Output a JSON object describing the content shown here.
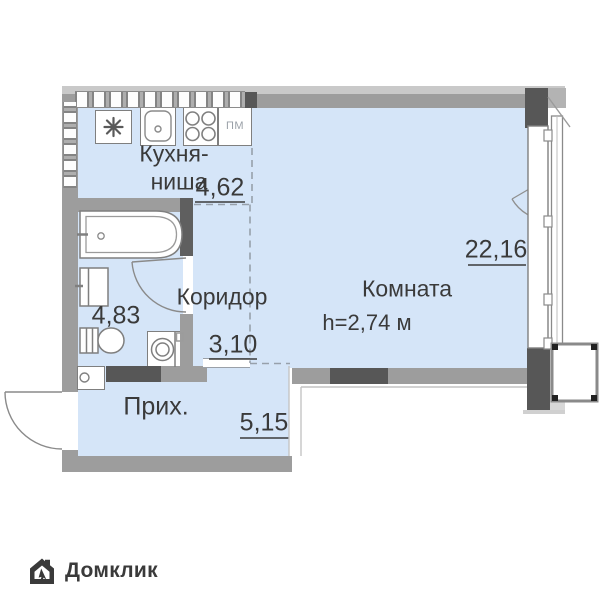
{
  "plan": {
    "kitchen": {
      "name_line1": "Кухня-",
      "name_line2": "ниша",
      "area": "4,62",
      "dishwasher": "ПМ"
    },
    "room": {
      "name": "Комната",
      "ceiling_height": "h=2,74 м",
      "area": "22,16"
    },
    "corridor": {
      "name": "Коридор",
      "area": "3,10"
    },
    "hallway": {
      "name": "Прих.",
      "area": "5,15"
    },
    "bathroom": {
      "area": "4,83"
    }
  },
  "branding": {
    "name": "Домклик"
  },
  "colors": {
    "floor": "#d5e5f8",
    "wall": "#9d9d9d",
    "wall_dark": "#575757",
    "text": "#3a3a3a"
  }
}
